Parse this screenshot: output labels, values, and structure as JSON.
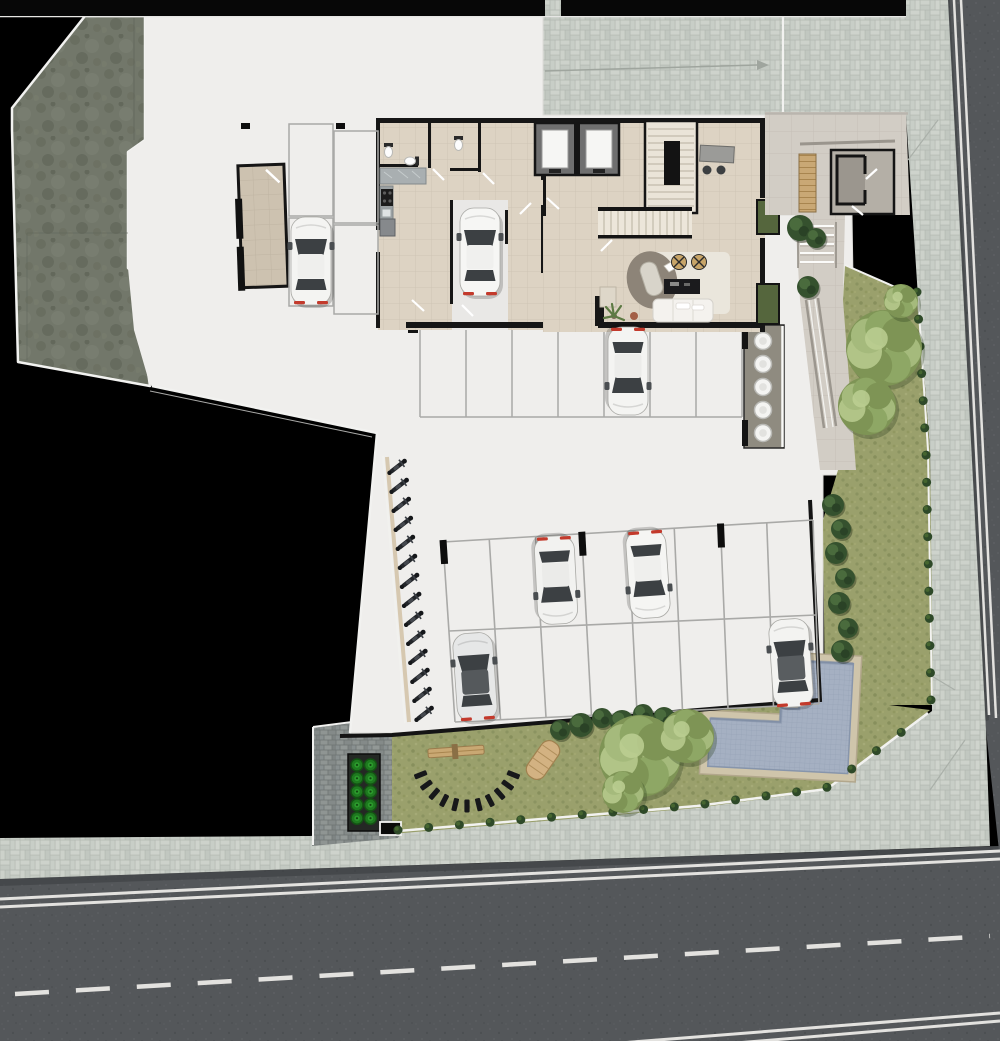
{
  "scene": {
    "type": "architectural-site-plan-top-view",
    "floor": "ground-floor-with-parking-garden-and-pool"
  },
  "colors": {
    "background": "#000000",
    "floor": "#efeeec",
    "terrain": "#72776a",
    "terrain_dark": "#5e6357",
    "paving_gap": "#b2b8b1",
    "paving_light": "#cdd2cb",
    "paving_dark": "#c0c6bf",
    "cobble": "#8f9593",
    "cobble_dark": "#7b8180",
    "road": "#54575a",
    "road_marking": "#e3e2df",
    "grass": "#9aa06c",
    "grass_dark": "#828b58",
    "tree_light": "#a5ba7c",
    "tree_mid": "#7e9455",
    "bush_dark": "#35512e",
    "shrub": "#2e4928",
    "pool_water": "#a5b0c2",
    "pool_tile": "#8e9cb2",
    "pool_deck": "#cfc5ab",
    "wall": "#161616",
    "tile_beige": "#ddd3c3",
    "tile_grid": "#cfc5b5",
    "entry_floor": "#d2cdc5",
    "wood": "#c9a875",
    "glass": "#3c4043",
    "taillight": "#c33a2c",
    "planter_green": "#1e7a1f",
    "counter": "#a9afb1",
    "stool": "#c8a568",
    "white_line": "#f2f2f0"
  },
  "vehicles": {
    "cars": [
      {
        "x": 311,
        "y": 261,
        "rot": 0,
        "body": "#f4f4f2",
        "roof": "#efefed"
      },
      {
        "x": 480,
        "y": 252,
        "rot": 0,
        "body": "#f6f6f4",
        "roof": "#f0f0ee"
      },
      {
        "x": 628,
        "y": 371,
        "rot": 180,
        "body": "#f4f4f2",
        "roof": "#ececea"
      },
      {
        "x": 556,
        "y": 580,
        "rot": 177,
        "body": "#f2f2f0",
        "roof": "#ebebe9"
      },
      {
        "x": 648,
        "y": 574,
        "rot": 176,
        "body": "#f5f5f3",
        "roof": "#efefed"
      },
      {
        "x": 475,
        "y": 677,
        "rot": -4,
        "body": "#e6e7e7",
        "roof": "#55595c"
      },
      {
        "x": 791,
        "y": 663,
        "rot": -4,
        "body": "#f3f3f1",
        "roof": "#595d60"
      }
    ],
    "motorcycles": {
      "x1": 397,
      "y1": 467,
      "x2": 424,
      "y2": 714,
      "count": 14,
      "angle": -38
    }
  },
  "parking": {
    "middle_row": {
      "x1": 420,
      "x2": 742,
      "y1": 328,
      "y2": 417,
      "stalls": 7
    },
    "upper_left_stalls": [
      [
        289,
        124,
        44,
        92
      ],
      [
        289,
        218,
        44,
        88
      ],
      [
        334,
        131,
        44,
        92
      ],
      [
        334,
        225,
        44,
        89
      ]
    ],
    "lower_lot": {
      "top": [
        [
          443,
          542
        ],
        [
          813,
          520
        ]
      ],
      "mid": [
        [
          449,
          631
        ],
        [
          816,
          615
        ]
      ],
      "bottom": [
        [
          455,
          722
        ],
        [
          819,
          704
        ]
      ],
      "columns": 9,
      "stub_columns": [
        0,
        3,
        6
      ]
    }
  },
  "tank_room": {
    "cx": 763,
    "cy_start": 341,
    "spacing": 23,
    "count": 5,
    "r": 8.5
  },
  "planter_box": {
    "x": 350,
    "y": 756,
    "cols": 2,
    "rows": 5,
    "dx": 13.5,
    "dy": 13.3,
    "r": 6
  },
  "gym": {
    "pads": {
      "cx": 467,
      "cy": 756,
      "r": 50,
      "from_deg": 22,
      "to_deg": 158,
      "count": 11
    }
  },
  "trees": [
    {
      "x": 884,
      "y": 348,
      "r": 38
    },
    {
      "x": 867,
      "y": 406,
      "r": 29
    },
    {
      "x": 901,
      "y": 301,
      "r": 17
    },
    {
      "x": 640,
      "y": 756,
      "r": 41
    },
    {
      "x": 687,
      "y": 736,
      "r": 27
    },
    {
      "x": 623,
      "y": 792,
      "r": 21
    }
  ],
  "bushes": [
    {
      "x": 800,
      "y": 228,
      "r": 13
    },
    {
      "x": 816,
      "y": 238,
      "r": 10
    },
    {
      "x": 808,
      "y": 287,
      "r": 11
    },
    {
      "x": 833,
      "y": 505,
      "r": 11
    },
    {
      "x": 841,
      "y": 529,
      "r": 10
    },
    {
      "x": 836,
      "y": 553,
      "r": 11
    },
    {
      "x": 845,
      "y": 578,
      "r": 10
    },
    {
      "x": 839,
      "y": 603,
      "r": 11
    },
    {
      "x": 848,
      "y": 628,
      "r": 10
    },
    {
      "x": 842,
      "y": 651,
      "r": 11
    },
    {
      "x": 560,
      "y": 730,
      "r": 10
    },
    {
      "x": 581,
      "y": 725,
      "r": 12
    },
    {
      "x": 602,
      "y": 718,
      "r": 10
    },
    {
      "x": 622,
      "y": 722,
      "r": 12
    },
    {
      "x": 643,
      "y": 714,
      "r": 10
    },
    {
      "x": 664,
      "y": 718,
      "r": 11
    }
  ],
  "shrub_rows": [
    {
      "pts": [
        [
          917,
          292
        ],
        [
          926,
          450
        ],
        [
          931,
          700
        ]
      ],
      "count": 16,
      "r": 4.5
    },
    {
      "pts": [
        [
          398,
          830
        ],
        [
          697,
          805
        ],
        [
          826,
          788
        ],
        [
          926,
          714
        ]
      ],
      "count": 19,
      "r": 4.5
    }
  ],
  "road_markings": [
    {
      "x1": 0,
      "y1": 899,
      "x2": 1000,
      "y2": 851,
      "w": 3,
      "dash": ""
    },
    {
      "x1": 0,
      "y1": 907,
      "x2": 1000,
      "y2": 859,
      "w": 3,
      "dash": ""
    },
    {
      "x1": 15,
      "y1": 994,
      "x2": 990,
      "y2": 936,
      "w": 4.5,
      "dash": "34 27"
    },
    {
      "x1": 620,
      "y1": 1043,
      "x2": 1000,
      "y2": 1013,
      "w": 3,
      "dash": ""
    },
    {
      "x1": 640,
      "y1": 1051,
      "x2": 1000,
      "y2": 1021,
      "w": 3,
      "dash": ""
    },
    {
      "x1": 954,
      "y1": 0,
      "x2": 989,
      "y2": 715,
      "w": 2.5,
      "dash": ""
    },
    {
      "x1": 961,
      "y1": 0,
      "x2": 996,
      "y2": 718,
      "w": 2.5,
      "dash": ""
    }
  ]
}
